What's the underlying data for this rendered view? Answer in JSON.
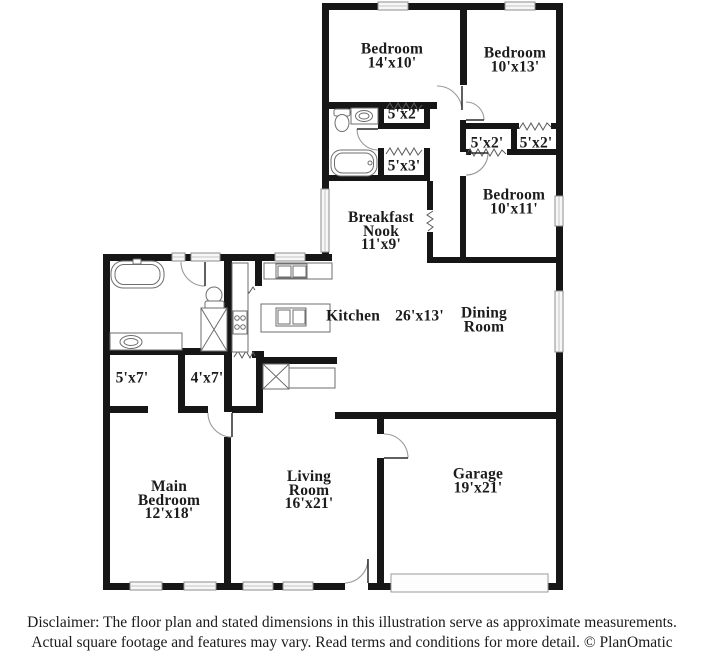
{
  "rooms": {
    "bedroom_top_left": {
      "name": "Bedroom",
      "dims": "14'x10'"
    },
    "bedroom_top_right": {
      "name": "Bedroom",
      "dims": "10'x13'"
    },
    "closet_hall_top": {
      "dims": "5'x2'"
    },
    "closet_pair_left": {
      "dims": "5'x2'"
    },
    "closet_pair_right": {
      "dims": "5'x2'"
    },
    "closet_linen": {
      "dims": "5'x3'"
    },
    "bedroom_mid_right": {
      "name": "Bedroom",
      "dims": "10'x11'"
    },
    "breakfast_nook": {
      "name": "Breakfast Nook",
      "dims": "11'x9'"
    },
    "kitchen": {
      "name": "Kitchen",
      "dims": "26'x13'"
    },
    "dining_room": {
      "name": "Dining Room"
    },
    "closet_5x7": {
      "dims": "5'x7'"
    },
    "closet_4x7": {
      "dims": "4'x7'"
    },
    "main_bedroom": {
      "name": "Main Bedroom",
      "dims": "12'x18'"
    },
    "living_room": {
      "name": "Living Room",
      "dims": "16'x21'"
    },
    "garage": {
      "name": "Garage",
      "dims": "19'x21'"
    }
  },
  "footer": {
    "disclaimer_line1": "Disclaimer: The floor plan and stated dimensions in this illustration serve as approximate measurements.",
    "disclaimer_line2": "Actual square footage and features may vary. Read terms and conditions for more detail. © PlanOmatic"
  }
}
